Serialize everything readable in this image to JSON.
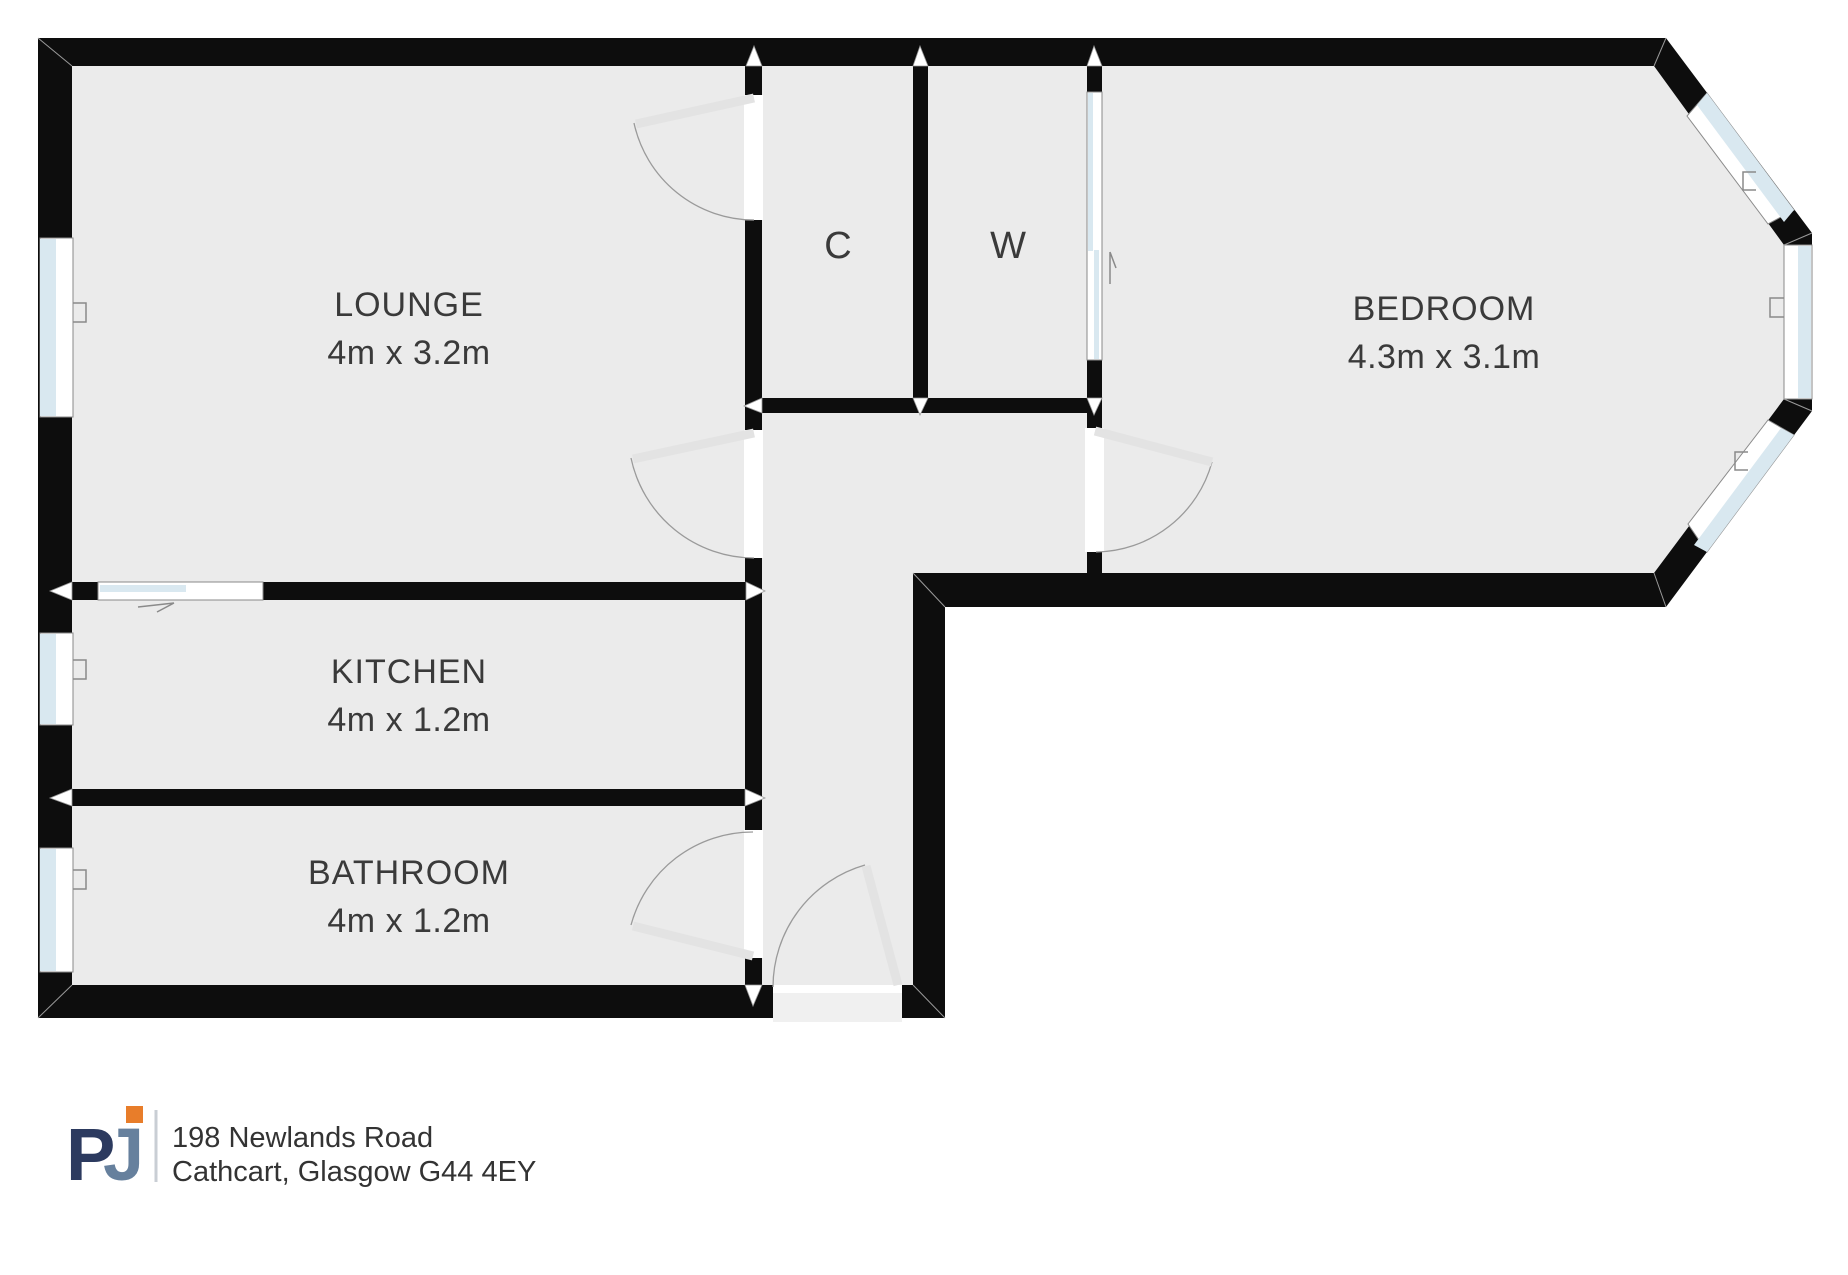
{
  "floorplan": {
    "rooms": [
      {
        "key": "lounge",
        "label": "LOUNGE",
        "dimensions": "4m x 3.2m"
      },
      {
        "key": "kitchen",
        "label": "KITCHEN",
        "dimensions": "4m x 1.2m"
      },
      {
        "key": "bathroom",
        "label": "BATHROOM",
        "dimensions": "4m x 1.2m"
      },
      {
        "key": "bedroom",
        "label": "BEDROOM",
        "dimensions": "4.3m x 3.1m"
      },
      {
        "key": "cupboard",
        "label": "C",
        "dimensions": ""
      },
      {
        "key": "wardrobe",
        "label": "W",
        "dimensions": ""
      }
    ]
  },
  "footer": {
    "logo": {
      "letter_p": "P",
      "letter_j": "J"
    },
    "address_line1": "198 Newlands Road",
    "address_line2": "Cathcart, Glasgow G44 4EY"
  },
  "colors": {
    "wall": "#0d0d0d",
    "floor": "#ebebeb",
    "window_glass": "#d9e8f0",
    "door_leaf": "#e3e3e3",
    "swing_arc": "#9a9a9a",
    "label_text": "#3a3a3a",
    "logo_navy": "#2c3a5f",
    "logo_slate": "#66809d",
    "logo_orange": "#e87d2a",
    "divider": "#c9ced4",
    "address_text": "#333333"
  }
}
